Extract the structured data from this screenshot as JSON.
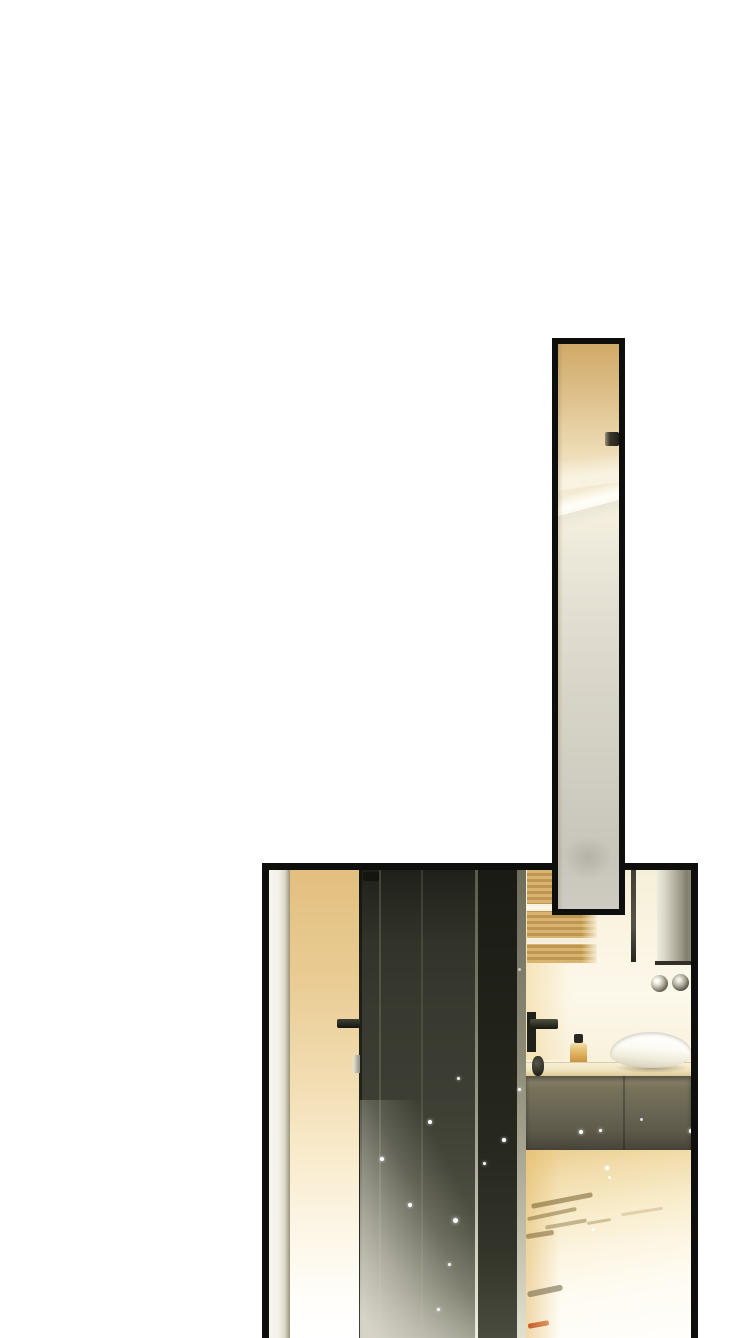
{
  "page": {
    "width": 755,
    "height": 1338,
    "background": "#ffffff",
    "kind": "comic-page",
    "text_content": "none"
  },
  "palette": {
    "panel_border": "#0e0e0c",
    "warm_wall": "#e3c182",
    "door_dark": "#33352a",
    "floor_amber": "#ebcd8d",
    "mirror_silver": "#b7b3a4",
    "sink_white": "#fdfbf4",
    "reflection_orange": "#c04e24"
  },
  "panels": [
    {
      "name": "panel-bathroom-scene",
      "x": 262,
      "y": 863,
      "w": 436,
      "h": 475,
      "z": 1,
      "border": "7px solid #0e0e0c",
      "extra": "border-bottom:none;background:#f8f3e3;",
      "elements": [
        {
          "name": "door-frame-strip",
          "style": "left:0;top:0;width:21px;height:468px;background:linear-gradient(90deg,#f7f5f0 0%,#f3f0e8 45%,#ddd8c9 75%,#b1ab97 92%,#978f77 100%);"
        },
        {
          "name": "warm-wall",
          "style": "left:21px;top:0;width:69px;height:468px;background:linear-gradient(180deg,#e2bf7f 0%,#eacd95 25%,#f2ddb2 45%,#f9ecce 62%,#fdf7e8 78%,#fffefa 92%,#ffffff 100%);"
        },
        {
          "name": "vanity-wall",
          "style": "left:257px;top:0;width:165px;height:192px;background:linear-gradient(180deg,#f6efd8 0%,#faf4e2 35%,#fcf8ea 65%,#f8f1dc 100%);"
        },
        {
          "name": "vanity-wall-warm-glow",
          "style": "left:257px;top:40px;width:45px;height:150px;background:linear-gradient(90deg,rgba(242,213,146,0.55),rgba(242,213,146,0));"
        },
        {
          "name": "towel-shelf",
          "style": "left:258px;top:0;width:70px;height:93px;background:linear-gradient(90deg,rgba(255,255,255,0) 0%,rgba(255,255,255,0) 78%,rgba(250,245,224,0.9) 100%),linear-gradient(180deg,rgba(255,252,240,0) 0px,rgba(255,252,240,0) 34px,rgba(255,252,242,0.9) 34px,rgba(255,252,242,0.9) 41px,rgba(255,252,240,0) 41px,rgba(255,252,240,0) 68px,rgba(255,252,242,0.85) 68px,rgba(255,252,242,0.85) 74px,rgba(255,252,240,0) 74px),repeating-linear-gradient(180deg,#d9b46f 0px,#d9b46f 3px,#bd9751 3px,#bd9751 6px);"
        },
        {
          "name": "mirror-edge-line",
          "style": "left:362px;top:0;width:5px;height:92px;background:linear-gradient(180deg,#413e33 0%,#565348 60%,#27251d 100%);"
        },
        {
          "name": "mirror-column",
          "style": "left:388px;top:0;width:34px;height:95px;background:linear-gradient(90deg,#edebdf 0%,#dbd8c9 22%,#b7b3a4 50%,#9b9786 72%,#827e6e 88%,#8f8b7b 100%);"
        },
        {
          "name": "mirror-bottom-edge",
          "style": "left:386px;top:91px;width:36px;height:4px;background:#312f26;"
        },
        {
          "name": "faucet-knob-left",
          "style": "left:382px;top:105px;width:17px;height:17px;border-radius:50%;background:radial-gradient(circle at 35% 35%,#fdfcf4 12%,#cdc9b8 35%,#6b685a 70%,#333128 100%);"
        },
        {
          "name": "faucet-knob-right",
          "style": "left:403px;top:104px;width:17px;height:17px;border-radius:50%;background:radial-gradient(circle at 40% 35%,#f2f0e4 10%,#a5a192 45%,#45433a 78%,#23211a 100%);"
        },
        {
          "name": "soap-bottle-cap",
          "style": "left:305px;top:164px;width:9px;height:9px;background:#2b2721;border-radius:2px;"
        },
        {
          "name": "soap-bottle",
          "style": "left:301px;top:173px;width:17px;height:22px;background:linear-gradient(180deg,#f2dfae 0%,#e4bd6e 35%,#d3a14c 70%,#bd8c3e 100%);border-radius:3px;"
        },
        {
          "name": "counter",
          "style": "left:257px;top:192px;width:165px;height:14px;background:linear-gradient(180deg,#f8f0d6 0%,#f1e5c2 55%,#dcc997 100%);box-shadow:inset 0 1px 0 rgba(120,100,60,0.25);"
        },
        {
          "name": "sink-shadow",
          "style": "left:346px;top:193px;width:74px;height:10px;border-radius:50%;background:radial-gradient(closest-side,rgba(100,85,45,0.5),rgba(100,85,45,0));"
        },
        {
          "name": "sink-bowl",
          "style": "left:341px;top:162px;width:82px;height:36px;border-radius:50% 50% 48% 48% / 62% 62% 38% 38%;background:linear-gradient(185deg,#ffffff 12%,#fdfbf4 45%,#f0ecda 70%,#d8d3bf 92%);box-shadow:inset 0 2px 3px rgba(160,155,130,0.45);"
        },
        {
          "name": "cabinet",
          "style": "left:257px;top:206px;width:165px;height:74px;background:linear-gradient(180deg,#8a8570 0%,#767258 18%,#6b6756 45%,#5e5a4a 75%,#46433a 100%);box-shadow:inset 0 3px 4px rgba(30,28,20,0.5);"
        },
        {
          "name": "cabinet-seam",
          "style": "left:354px;top:206px;width:2px;height:74px;background:rgba(20,18,12,0.3);"
        },
        {
          "name": "floor",
          "style": "left:257px;top:280px;width:165px;height:188px;background:linear-gradient(170deg,#ebcd8d 0%,#f2deae 16%,#f8ecca 34%,#fcf5e2 52%,#fefbf1 70%,#fffefb 100%);"
        },
        {
          "name": "floor-warm-left",
          "style": "left:257px;top:280px;width:34px;height:188px;background:linear-gradient(90deg,rgba(228,186,105,0.55),rgba(228,186,105,0));"
        },
        {
          "name": "floor-reflection-streak",
          "style": "left:262px;top:328px;width:62px;height:5px;background:rgba(114,92,44,0.55);transform:rotate(-11deg);border-radius:2px;"
        },
        {
          "name": "floor-reflection-streak",
          "style": "left:258px;top:342px;width:50px;height:4px;background:rgba(126,102,52,0.5);transform:rotate(-12deg);border-radius:2px;"
        },
        {
          "name": "floor-reflection-streak",
          "style": "left:276px;top:352px;width:42px;height:4px;background:rgba(134,110,60,0.45);transform:rotate(-10deg);border-radius:2px;"
        },
        {
          "name": "floor-reflection-streak",
          "style": "left:257px;top:362px;width:28px;height:5px;background:rgba(108,86,40,0.5);transform:rotate(-9deg);border-radius:2px;"
        },
        {
          "name": "floor-reflection-streak",
          "style": "left:318px;top:350px;width:24px;height:3px;background:rgba(150,126,76,0.4);transform:rotate(-10deg);border-radius:2px;"
        },
        {
          "name": "floor-reflection-streak",
          "style": "left:352px;top:340px;width:42px;height:3px;background:rgba(165,140,90,0.3);transform:rotate(-9deg);border-radius:2px;"
        },
        {
          "name": "floor-reflection-streak",
          "style": "left:258px;top:418px;width:36px;height:6px;background:rgba(104,92,62,0.55);transform:rotate(-12deg);border-radius:3px;"
        },
        {
          "name": "floor-reflection-orange",
          "style": "left:259px;top:452px;width:21px;height:5px;background:linear-gradient(90deg,#c04e24,#da8c4c);transform:rotate(-10deg);border-radius:2px;opacity:0.9;"
        },
        {
          "name": "door",
          "style": "left:90px;top:0;width:158px;height:468px;background:linear-gradient(180deg,#1e2019 0%,#272921 6%,#32342a 16%,#383a2f 30%,#3c3e33 48%,#45473a 64%,#525446 78%,#686a5a 90%,#8b8c7d 100%);"
        },
        {
          "name": "door-left-edge",
          "style": "left:90px;top:0;width:3px;height:468px;background:rgba(10,12,6,0.55);"
        },
        {
          "name": "door-seam",
          "style": "left:110px;top:0;width:2px;height:468px;background:rgba(145,148,122,0.3);"
        },
        {
          "name": "door-seam",
          "style": "left:152px;top:0;width:2px;height:468px;background:rgba(145,148,122,0.22);"
        },
        {
          "name": "door-top-hinge",
          "style": "left:94px;top:2px;width:16px;height:9px;background:#14150e;border-radius:2px;"
        },
        {
          "name": "door-light-line",
          "style": "left:206px;top:0;width:3px;height:468px;background:linear-gradient(180deg,#595b4a 0%,#7b7d6a 30%,#a7a795 60%,#d9d7c5 85%,#efeee1 100%);"
        },
        {
          "name": "door-dark-strip",
          "style": "left:209px;top:0;width:39px;height:468px;background:linear-gradient(180deg,#191b14 0%,#20221a 30%,#272920 60%,#33352a 82%,#4a4c3f 100%);"
        },
        {
          "name": "door-edge-highlight",
          "style": "left:248px;top:0;width:9px;height:468px;background:linear-gradient(180deg,#6e6d5c 0%,#8b8a77 40%,#bdbaa6 75%,#e3e0d0 100%);"
        },
        {
          "name": "door-glow",
          "style": "left:91px;top:230px;width:116px;height:238px;background:linear-gradient(to top right,rgba(219,216,203,0.95) 6%,rgba(219,216,203,0.6) 30%,rgba(219,216,203,0.2) 55%,rgba(219,216,203,0) 75%);"
        },
        {
          "name": "door-handle-left",
          "style": "left:68px;top:149px;width:23px;height:9px;background:linear-gradient(180deg,#3f4136,#15160f);border-radius:2px;"
        },
        {
          "name": "door-strike-plate",
          "style": "left:84px;top:185px;width:7px;height:18px;background:linear-gradient(90deg,#e9e7d9,#8f8f7d);"
        },
        {
          "name": "door-handle-plate-right",
          "style": "left:258px;top:142px;width:9px;height:40px;background:#20211a;"
        },
        {
          "name": "door-handle-right",
          "style": "left:261px;top:149px;width:28px;height:10px;background:linear-gradient(180deg,#50513f,#17180f);border-radius:2px;"
        },
        {
          "name": "door-knob-right",
          "style": "left:263px;top:186px;width:12px;height:20px;background:radial-gradient(circle at 40% 35%,#565748,#15160e);border-radius:45%;"
        },
        {
          "name": "sparkle-dot",
          "style": "left:159px;top:250px;width:4px;height:4px;border-radius:50%;background:#fff;box-shadow:0 0 3px rgba(255,255,255,0.9);"
        },
        {
          "name": "sparkle-dot",
          "style": "left:233px;top:268px;width:4px;height:4px;border-radius:50%;background:#fff;box-shadow:0 0 3px rgba(255,255,255,0.9);"
        },
        {
          "name": "sparkle-dot",
          "style": "left:111px;top:287px;width:4px;height:4px;border-radius:50%;background:#fff;box-shadow:0 0 3px rgba(255,255,255,0.9);"
        },
        {
          "name": "sparkle-dot",
          "style": "left:214px;top:292px;width:3px;height:3px;border-radius:50%;background:#fff;box-shadow:0 0 3px rgba(255,255,255,0.9);"
        },
        {
          "name": "sparkle-dot",
          "style": "left:139px;top:333px;width:4px;height:4px;border-radius:50%;background:#fff;box-shadow:0 0 3px rgba(255,255,255,0.9);"
        },
        {
          "name": "sparkle-dot",
          "style": "left:184px;top:348px;width:5px;height:5px;border-radius:50%;background:#fff;box-shadow:0 0 4px rgba(255,255,255,0.9);"
        },
        {
          "name": "sparkle-dot",
          "style": "left:179px;top:393px;width:3px;height:3px;border-radius:50%;background:#fff;box-shadow:0 0 3px rgba(255,255,255,0.8);"
        },
        {
          "name": "sparkle-dot",
          "style": "left:168px;top:438px;width:3px;height:3px;border-radius:50%;background:#fff;box-shadow:0 0 3px rgba(255,255,255,0.8);"
        },
        {
          "name": "sparkle-dot",
          "style": "left:188px;top:207px;width:3px;height:3px;border-radius:50%;background:#fff;box-shadow:0 0 3px rgba(255,255,255,0.8);"
        },
        {
          "name": "sparkle-dot",
          "style": "left:249px;top:218px;width:3px;height:3px;border-radius:50%;background:#fff;box-shadow:0 0 3px rgba(255,255,255,0.8);"
        },
        {
          "name": "sparkle-dot",
          "style": "left:249px;top:98px;width:3px;height:3px;border-radius:50%;background:#fff;opacity:0.6;"
        },
        {
          "name": "sparkle-dot",
          "style": "left:310px;top:260px;width:4px;height:4px;border-radius:50%;background:#fff;box-shadow:0 0 3px rgba(255,255,255,0.9);"
        },
        {
          "name": "sparkle-dot",
          "style": "left:330px;top:259px;width:3px;height:3px;border-radius:50%;background:#fff;box-shadow:0 0 3px rgba(255,255,255,0.9);"
        },
        {
          "name": "sparkle-dot",
          "style": "left:371px;top:248px;width:3px;height:3px;border-radius:50%;background:#fff;opacity:0.8;"
        },
        {
          "name": "sparkle-dot",
          "style": "left:420px;top:259px;width:4px;height:4px;border-radius:50%;background:#fff;box-shadow:0 0 3px rgba(255,255,255,0.9);"
        },
        {
          "name": "sparkle-dot",
          "style": "left:336px;top:296px;width:4px;height:4px;border-radius:50%;background:#fff;box-shadow:0 0 3px rgba(255,255,255,0.9);"
        },
        {
          "name": "sparkle-dot",
          "style": "left:339px;top:306px;width:3px;height:3px;border-radius:50%;background:#fff;opacity:0.8;"
        },
        {
          "name": "sparkle-dot",
          "style": "left:323px;top:358px;width:3px;height:3px;border-radius:50%;background:#fff;opacity:0.8;"
        }
      ]
    },
    {
      "name": "panel-mirror-sliver",
      "x": 552,
      "y": 338,
      "w": 73,
      "h": 577,
      "z": 2,
      "border": "6px solid #0e0e0c",
      "extra": "background:linear-gradient(180deg,#d0a967 0%,#ddc08a 9%,#ecd9b1 18%,#f4ead0 25%,#f5efde 30%,#ebe7d9 38%,#e2ded1 48%,#d8d5c8 62%,#cfccc1 78%,#c8c5bb 90%,#cecbc2 100%);",
      "elements": [
        {
          "name": "reflection-upper-sheen",
          "style": "left:-10px;top:112px;width:84px;height:30px;background:linear-gradient(180deg,rgba(250,243,222,0) 0%,rgba(250,245,229,0.85) 70%,rgba(248,243,226,0.95) 100%);transform:rotate(-8deg);"
        },
        {
          "name": "reflection-counter-highlight",
          "style": "left:-10px;top:146px;width:84px;height:20px;background:linear-gradient(180deg,rgba(255,255,250,0.1) 0%,#fffef7 55%,#faf8ee 100%);transform:rotate(-15deg);"
        },
        {
          "name": "reflection-counter-shadow",
          "style": "left:-10px;top:164px;width:84px;height:16px;background:linear-gradient(180deg,#e9e5d6 0%,rgba(228,224,212,0) 90%);transform:rotate(-15deg);"
        },
        {
          "name": "sliver-door-handle",
          "style": "left:47px;top:88px;width:14px;height:14px;background:linear-gradient(90deg,#9a9078 0%,#3a362b 35%,#23211a 100%);border-radius:2px;"
        },
        {
          "name": "reflection-lower-smudge",
          "style": "left:6px;top:492px;width:48px;height:44px;background:radial-gradient(closest-side,rgba(138,132,118,0.3),rgba(138,132,118,0));"
        },
        {
          "name": "sliver-left-edge-shade",
          "style": "left:0;top:0;width:5px;height:565px;background:linear-gradient(90deg,rgba(125,102,60,0.22),rgba(125,102,60,0));"
        }
      ]
    }
  ]
}
